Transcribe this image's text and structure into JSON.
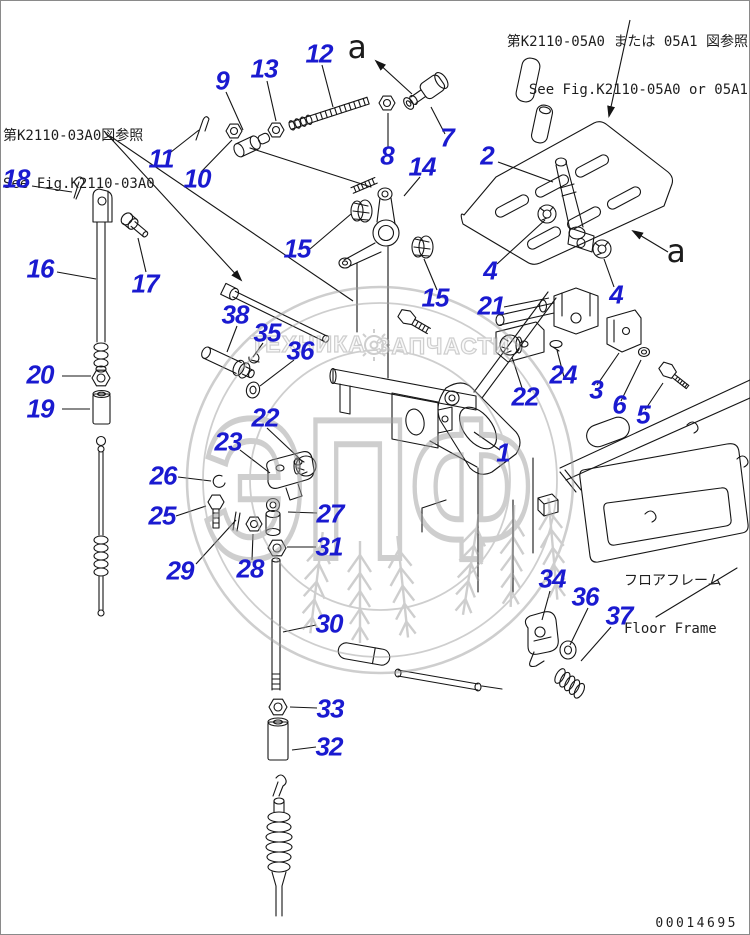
{
  "doc": {
    "type_label": "parts-diagram",
    "ref_top_right_jp": "第K2110-05A0 または 05A1 図参照",
    "ref_top_right_en": "See Fig.K2110-05A0 or 05A1",
    "ref_left_jp": "第K2110-03A0図参照",
    "ref_left_en": "See Fig.K2110-03A0",
    "floor_frame_jp": "フロアフレーム",
    "floor_frame_en": "Floor Frame",
    "doc_number": "00014695",
    "callout_color": "#1a1ad0",
    "line_color": "#151515",
    "watermark_color": "#c3c3c3"
  },
  "watermark": {
    "text_left": "ТЕХНИКА",
    "text_right": "ЗАПЧАСТИ",
    "logo_text": "ЭПФ",
    "gear_icon": "gear-icon"
  },
  "view_labels": [
    {
      "text": "a",
      "x": 357,
      "y": 47
    },
    {
      "text": "a",
      "x": 676,
      "y": 251
    }
  ],
  "callouts": [
    {
      "label": "18",
      "x": 16,
      "y": 179
    },
    {
      "label": "16",
      "x": 40,
      "y": 269
    },
    {
      "label": "17",
      "x": 145,
      "y": 284
    },
    {
      "label": "20",
      "x": 40,
      "y": 375
    },
    {
      "label": "19",
      "x": 40,
      "y": 409
    },
    {
      "label": "11",
      "x": 161,
      "y": 159
    },
    {
      "label": "10",
      "x": 197,
      "y": 179
    },
    {
      "label": "9",
      "x": 222,
      "y": 81
    },
    {
      "label": "13",
      "x": 264,
      "y": 69
    },
    {
      "label": "12",
      "x": 319,
      "y": 54
    },
    {
      "label": "8",
      "x": 387,
      "y": 156
    },
    {
      "label": "7",
      "x": 447,
      "y": 138
    },
    {
      "label": "14",
      "x": 422,
      "y": 167
    },
    {
      "label": "2",
      "x": 487,
      "y": 156
    },
    {
      "label": "15",
      "x": 297,
      "y": 249
    },
    {
      "label": "15",
      "x": 435,
      "y": 298
    },
    {
      "label": "4",
      "x": 490,
      "y": 271
    },
    {
      "label": "4",
      "x": 616,
      "y": 295
    },
    {
      "label": "21",
      "x": 491,
      "y": 306
    },
    {
      "label": "38",
      "x": 235,
      "y": 315
    },
    {
      "label": "35",
      "x": 267,
      "y": 333
    },
    {
      "label": "36",
      "x": 300,
      "y": 351
    },
    {
      "label": "22",
      "x": 525,
      "y": 397
    },
    {
      "label": "24",
      "x": 563,
      "y": 375
    },
    {
      "label": "3",
      "x": 596,
      "y": 390
    },
    {
      "label": "6",
      "x": 619,
      "y": 405
    },
    {
      "label": "5",
      "x": 643,
      "y": 415
    },
    {
      "label": "22",
      "x": 265,
      "y": 418
    },
    {
      "label": "23",
      "x": 228,
      "y": 442
    },
    {
      "label": "1",
      "x": 503,
      "y": 453
    },
    {
      "label": "26",
      "x": 163,
      "y": 476
    },
    {
      "label": "25",
      "x": 162,
      "y": 516
    },
    {
      "label": "27",
      "x": 330,
      "y": 514
    },
    {
      "label": "31",
      "x": 329,
      "y": 547
    },
    {
      "label": "28",
      "x": 250,
      "y": 569
    },
    {
      "label": "29",
      "x": 180,
      "y": 571
    },
    {
      "label": "30",
      "x": 329,
      "y": 624
    },
    {
      "label": "33",
      "x": 330,
      "y": 709
    },
    {
      "label": "32",
      "x": 329,
      "y": 747
    },
    {
      "label": "34",
      "x": 552,
      "y": 579
    },
    {
      "label": "36",
      "x": 585,
      "y": 597
    },
    {
      "label": "37",
      "x": 619,
      "y": 616
    }
  ],
  "leaders": [
    {
      "x1": 32,
      "y1": 186,
      "x2": 72,
      "y2": 192,
      "arrow": false
    },
    {
      "x1": 57,
      "y1": 272,
      "x2": 96,
      "y2": 279,
      "arrow": false
    },
    {
      "x1": 146,
      "y1": 272,
      "x2": 138,
      "y2": 238,
      "arrow": false
    },
    {
      "x1": 62,
      "y1": 376,
      "x2": 91,
      "y2": 376,
      "arrow": false
    },
    {
      "x1": 62,
      "y1": 409,
      "x2": 90,
      "y2": 409,
      "arrow": false
    },
    {
      "x1": 171,
      "y1": 152,
      "x2": 199,
      "y2": 130,
      "arrow": false
    },
    {
      "x1": 201,
      "y1": 172,
      "x2": 232,
      "y2": 140,
      "arrow": false
    },
    {
      "x1": 226,
      "y1": 92,
      "x2": 243,
      "y2": 130,
      "arrow": false
    },
    {
      "x1": 267,
      "y1": 81,
      "x2": 276,
      "y2": 121,
      "arrow": false
    },
    {
      "x1": 322,
      "y1": 65,
      "x2": 333,
      "y2": 107,
      "arrow": false
    },
    {
      "x1": 388,
      "y1": 147,
      "x2": 388,
      "y2": 113,
      "arrow": false
    },
    {
      "x1": 445,
      "y1": 134,
      "x2": 431,
      "y2": 107,
      "arrow": false
    },
    {
      "x1": 420,
      "y1": 177,
      "x2": 404,
      "y2": 196,
      "arrow": false
    },
    {
      "x1": 498,
      "y1": 162,
      "x2": 553,
      "y2": 182,
      "arrow": false
    },
    {
      "x1": 497,
      "y1": 264,
      "x2": 545,
      "y2": 220,
      "arrow": false
    },
    {
      "x1": 614,
      "y1": 287,
      "x2": 604,
      "y2": 259,
      "arrow": false
    },
    {
      "x1": 504,
      "y1": 307,
      "x2": 549,
      "y2": 298,
      "arrow": false
    },
    {
      "x1": 310,
      "y1": 249,
      "x2": 351,
      "y2": 214,
      "arrow": false
    },
    {
      "x1": 437,
      "y1": 290,
      "x2": 424,
      "y2": 259,
      "arrow": false
    },
    {
      "x1": 237,
      "y1": 326,
      "x2": 227,
      "y2": 352,
      "arrow": false
    },
    {
      "x1": 263,
      "y1": 343,
      "x2": 253,
      "y2": 357,
      "arrow": false
    },
    {
      "x1": 294,
      "y1": 360,
      "x2": 260,
      "y2": 386,
      "arrow": false
    },
    {
      "x1": 523,
      "y1": 391,
      "x2": 512,
      "y2": 357,
      "arrow": false
    },
    {
      "x1": 564,
      "y1": 377,
      "x2": 557,
      "y2": 350,
      "arrow": false
    },
    {
      "x1": 597,
      "y1": 385,
      "x2": 619,
      "y2": 353,
      "arrow": false
    },
    {
      "x1": 621,
      "y1": 401,
      "x2": 641,
      "y2": 360,
      "arrow": false
    },
    {
      "x1": 645,
      "y1": 410,
      "x2": 663,
      "y2": 383,
      "arrow": false
    },
    {
      "x1": 500,
      "y1": 450,
      "x2": 474,
      "y2": 432,
      "arrow": false
    },
    {
      "x1": 267,
      "y1": 428,
      "x2": 300,
      "y2": 459,
      "arrow": false
    },
    {
      "x1": 240,
      "y1": 450,
      "x2": 270,
      "y2": 473,
      "arrow": false
    },
    {
      "x1": 178,
      "y1": 477,
      "x2": 211,
      "y2": 481,
      "arrow": false
    },
    {
      "x1": 176,
      "y1": 516,
      "x2": 206,
      "y2": 506,
      "arrow": false
    },
    {
      "x1": 317,
      "y1": 513,
      "x2": 288,
      "y2": 512,
      "arrow": false
    },
    {
      "x1": 316,
      "y1": 547,
      "x2": 287,
      "y2": 547,
      "arrow": false
    },
    {
      "x1": 252,
      "y1": 560,
      "x2": 253,
      "y2": 534,
      "arrow": false
    },
    {
      "x1": 196,
      "y1": 564,
      "x2": 236,
      "y2": 520,
      "arrow": false
    },
    {
      "x1": 316,
      "y1": 625,
      "x2": 283,
      "y2": 632,
      "arrow": false
    },
    {
      "x1": 317,
      "y1": 708,
      "x2": 290,
      "y2": 707,
      "arrow": false
    },
    {
      "x1": 316,
      "y1": 747,
      "x2": 292,
      "y2": 750,
      "arrow": false
    },
    {
      "x1": 550,
      "y1": 591,
      "x2": 542,
      "y2": 620,
      "arrow": false
    },
    {
      "x1": 588,
      "y1": 608,
      "x2": 570,
      "y2": 645,
      "arrow": false
    },
    {
      "x1": 611,
      "y1": 627,
      "x2": 581,
      "y2": 661,
      "arrow": false
    },
    {
      "x1": 412,
      "y1": 94,
      "x2": 376,
      "y2": 61,
      "arrow": true
    },
    {
      "x1": 668,
      "y1": 252,
      "x2": 633,
      "y2": 231,
      "arrow": true
    },
    {
      "x1": 630,
      "y1": 20,
      "x2": 609,
      "y2": 116,
      "arrow": true
    },
    {
      "x1": 104,
      "y1": 131,
      "x2": 241,
      "y2": 280,
      "arrow": true
    },
    {
      "x1": 110,
      "y1": 136,
      "x2": 353,
      "y2": 301,
      "arrow": false
    }
  ]
}
